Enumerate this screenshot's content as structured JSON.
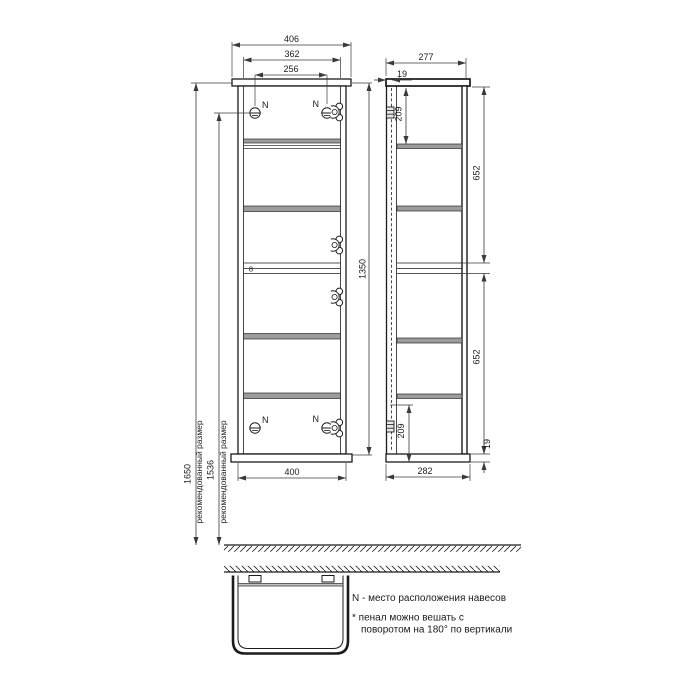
{
  "front": {
    "width_overall": "406",
    "width_inner": "362",
    "hanger_spacing": "256",
    "width_bottom": "400",
    "height": "1350",
    "divider_thickness": "8",
    "hanger_mark": "N",
    "recommended_1": {
      "value": "1650",
      "label": "рекомендованный размер"
    },
    "recommended_2": {
      "value": "1536",
      "label": "рекомендованный размер"
    }
  },
  "side": {
    "depth_top": "277",
    "back_offset": "19",
    "hanger_from_top": "209",
    "section_upper": "652",
    "section_lower": "652",
    "hanger_from_bottom": "209",
    "cap_thickness": "19",
    "depth_bottom": "282"
  },
  "notes": {
    "hangers": "N - место расположения навесов",
    "rotate_line1": "* пенал можно вешать с",
    "rotate_line2": "поворотом на 180° по вертикали"
  }
}
